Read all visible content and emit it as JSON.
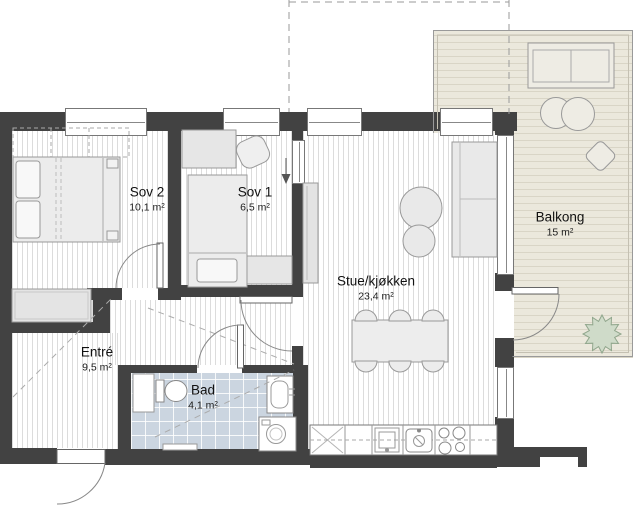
{
  "rooms": [
    {
      "id": "sov2",
      "name": "Sov 2",
      "area": "10,1 m²"
    },
    {
      "id": "sov1",
      "name": "Sov 1",
      "area": "6,5 m²"
    },
    {
      "id": "stue",
      "name": "Stue/kjøkken",
      "area": "23,4 m²"
    },
    {
      "id": "balkong",
      "name": "Balkong",
      "area": "15 m²"
    },
    {
      "id": "entre",
      "name": "Entré",
      "area": "9,5 m²"
    },
    {
      "id": "bad",
      "name": "Bad",
      "area": "4,1 m²"
    }
  ],
  "colors": {
    "wall": "#424242",
    "bathroom_tile": "#cbd5e0",
    "balcony_floor": "#ebe8dc",
    "plant_green": "#cfdbc9"
  }
}
